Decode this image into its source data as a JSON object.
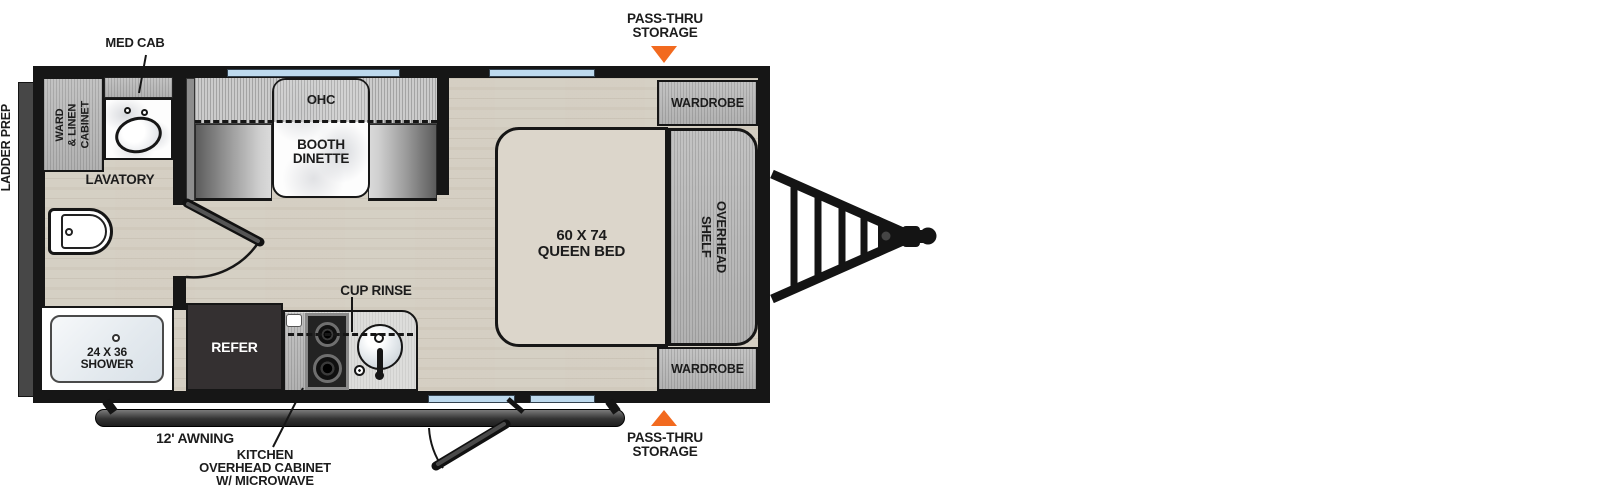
{
  "labels": {
    "ladder_prep": "LADDER PREP",
    "med_cab": "MED CAB",
    "ward_linen_cabinet": "WARD\n& LINEN\nCABINET",
    "lavatory": "LAVATORY",
    "shower": "24 X 36\nSHOWER",
    "ohc": "OHC",
    "booth_dinette": "BOOTH\nDINETTE",
    "refer": "REFER",
    "cup_rinse": "CUP RINSE",
    "kitchen_overhead_cabinet": "KITCHEN\nOVERHEAD CABINET\nW/ MICROWAVE",
    "awning": "12' AWNING",
    "queen_bed": "60 X 74\nQUEEN BED",
    "overhead_shelf": "OVERHEAD\nSHELF",
    "wardrobe_top": "WARDROBE",
    "wardrobe_bottom": "WARDROBE",
    "pass_thru_storage_top": "PASS-THRU\nSTORAGE",
    "pass_thru_storage_bottom": "PASS-THRU\nSTORAGE"
  },
  "colors": {
    "accent_orange": "#F26A1F",
    "window_blue": "#BDD9ED",
    "wall_black": "#161616",
    "cabinet_gray": "#BABABA",
    "floor_tan": "#D9D4C9",
    "bed_beige": "#DCD6CB",
    "refer_dark": "#343031"
  }
}
